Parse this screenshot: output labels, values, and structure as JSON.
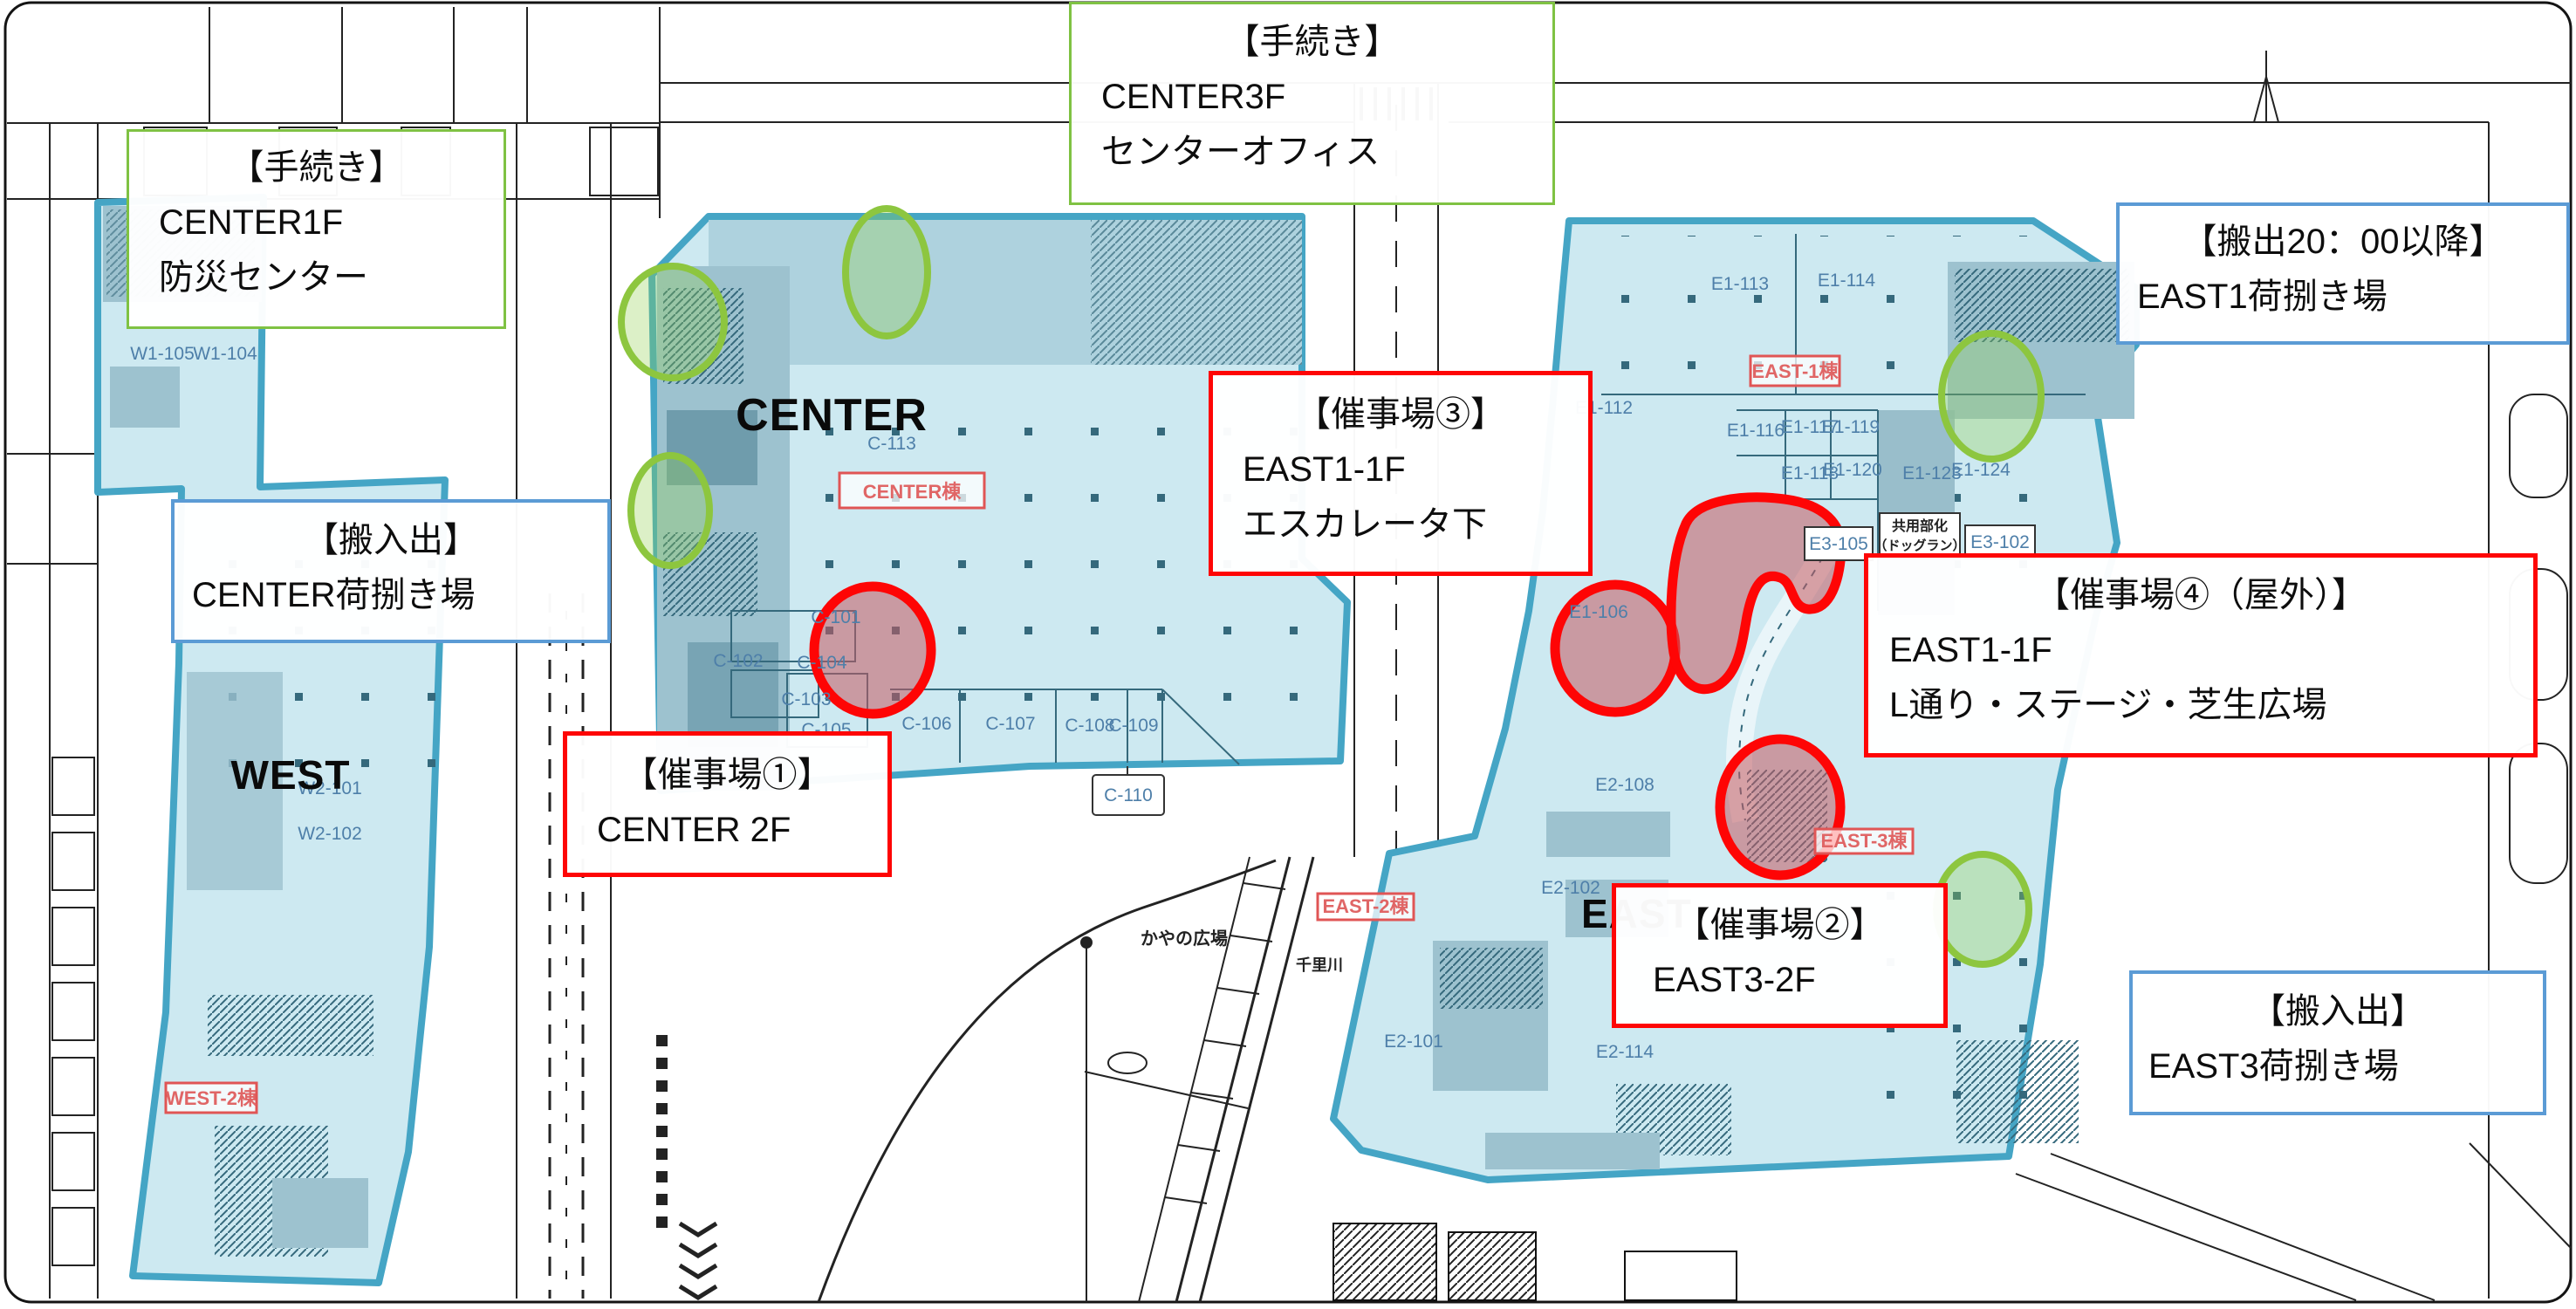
{
  "building_labels": {
    "west": "WEST",
    "center": "CENTER",
    "east": "EAST"
  },
  "building_tags": {
    "center": "CENTER棟",
    "east1": "EAST-1棟",
    "east2": "EAST-2棟",
    "east3": "EAST-3棟",
    "west2": "WEST-2棟"
  },
  "room_codes": [
    "W1-105",
    "W1-104",
    "W2-101",
    "W2-102",
    "C-113",
    "C-101",
    "C-102",
    "C-104",
    "C-103",
    "C-105",
    "C-106",
    "C-107",
    "C-108",
    "C-109",
    "C-110",
    "E1-113",
    "E1-114",
    "E1-112",
    "E1-116",
    "E1-117",
    "E1-119",
    "E1-118",
    "E1-120",
    "E1-123",
    "E1-124",
    "E3-105",
    "E3-102",
    "E1-106",
    "E2-108",
    "E2-102",
    "E2-101",
    "E2-114"
  ],
  "place_labels": {
    "plaza": "かやの広場",
    "river": "千里川",
    "kyoyo1": "共用部化",
    "kyoyo2": "（ドッグラン）"
  },
  "callouts": {
    "procedure_center1f": {
      "title": "【手続き】",
      "line1": "CENTER1F",
      "line2": "防災センター"
    },
    "procedure_center3f": {
      "title": "【手続き】",
      "line1": "CENTER3F",
      "line2": "センターオフィス"
    },
    "carryout_east1": {
      "title": "【搬出20：00以降】",
      "line1": "EAST1荷捌き場"
    },
    "loading_center": {
      "title": "【搬入出】",
      "line1": "CENTER荷捌き場"
    },
    "venue1": {
      "title": "【催事場①】",
      "line1": "CENTER 2F"
    },
    "venue2": {
      "title": "【催事場②】",
      "line1": "EAST3-2F"
    },
    "venue3": {
      "title": "【催事場③】",
      "line1": "EAST1-1F",
      "line2": "エスカレータ下"
    },
    "venue4": {
      "title": "【催事場④（屋外）】",
      "line1": "EAST1-1F",
      "line2": "L通り・ステージ・芝生広場"
    },
    "loading_east3": {
      "title": "【搬入出】",
      "line1": "EAST3荷捌き場"
    }
  },
  "colors": {
    "building_fill": "#cde9f1",
    "building_stroke": "#45a5c5",
    "detail_mid": "#9dc2cf",
    "detail_dark": "#35697c",
    "green_marker": "#8dc63f",
    "red_marker": "#fe0505",
    "red_marker_fill": "rgba(198,89,97,0.55)",
    "green_marker_fill": "rgba(146,208,80,0.32)",
    "room_code_text": "#4e7fa9",
    "tag_text": "#e06666",
    "callout_green_border": "#7fc243",
    "callout_blue_border": "#5b9bd5",
    "callout_red_border": "#fe0505"
  }
}
